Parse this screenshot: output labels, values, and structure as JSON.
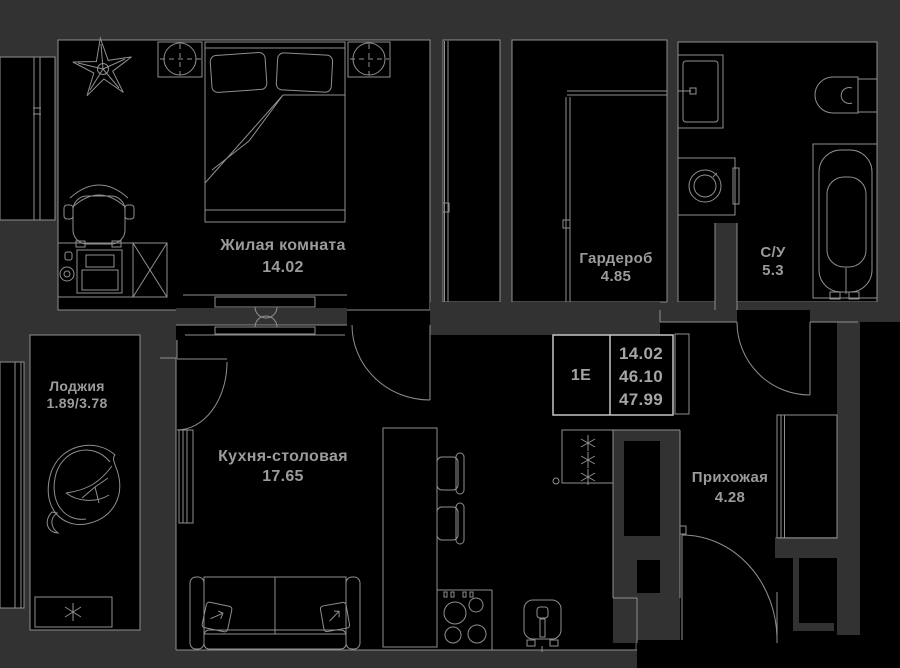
{
  "plan_title": "Floor plan unit 1Е",
  "colors": {
    "background": "#323232",
    "room_fill": "#000000",
    "line": "#8f8f8f",
    "bright_line": "#c6c6c6",
    "text": "#9b9b9b"
  },
  "rooms": [
    {
      "name": "Жилая комната",
      "area": "14.02"
    },
    {
      "name": "Гардероб",
      "area": "4.85"
    },
    {
      "name": "С/У",
      "area": "5.3"
    },
    {
      "name": "Лоджия",
      "area": "1.89/3.78"
    },
    {
      "name": "Кухня-столовая",
      "area": "17.65"
    },
    {
      "name": "Прихожая",
      "area": "4.28"
    }
  ],
  "info_box": {
    "unit_label": "1Е",
    "living_area": "14.02",
    "area_without_loggia": "46.10",
    "total_area": "47.99"
  }
}
